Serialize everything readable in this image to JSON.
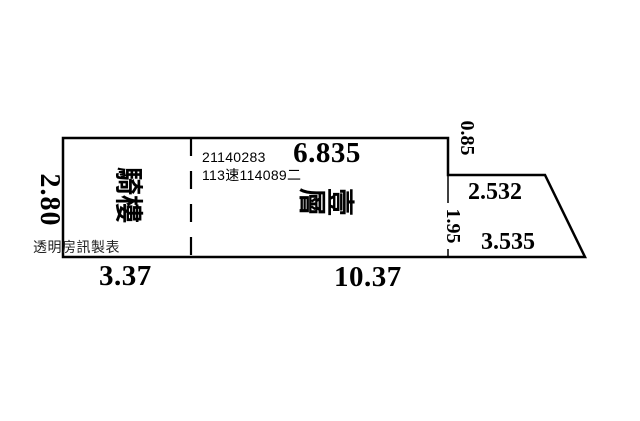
{
  "plan": {
    "type": "floor-plan",
    "room_labels": {
      "arcade": "騎樓",
      "first_floor": "壹層"
    },
    "annotations": {
      "registration_number": "21140283",
      "case_number": "113速114089二",
      "watermark": "透明房訊製表"
    },
    "dimensions": {
      "top_width": "6.835",
      "left_height": "2.80",
      "right_upper": "0.85",
      "annex_top": "2.532",
      "right_lower": "1.95",
      "annex_bottom": "3.535",
      "bottom_left": "3.37",
      "bottom_middle": "10.37"
    },
    "colors": {
      "ink": "#000000",
      "paper": "#ffffff"
    }
  }
}
